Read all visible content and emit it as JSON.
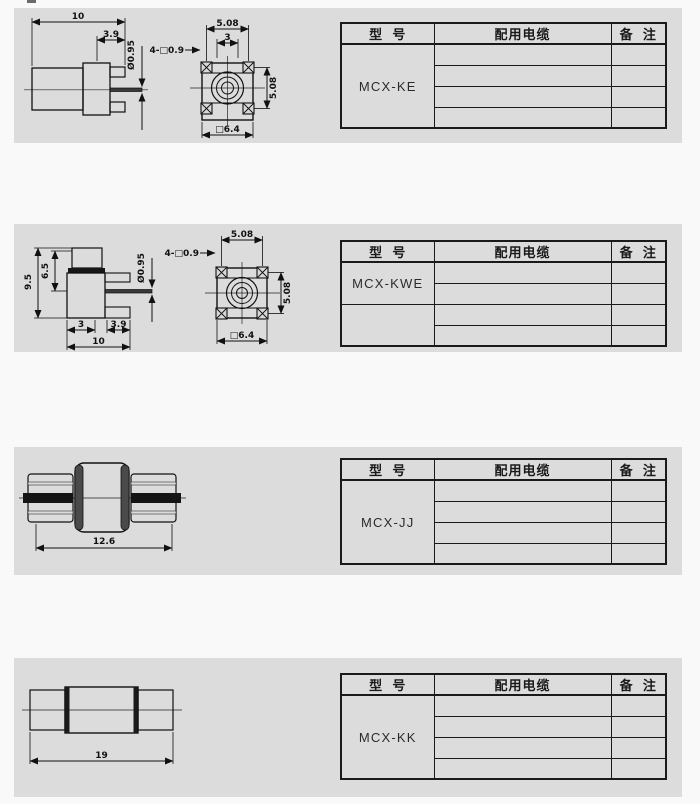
{
  "colors": {
    "panel": "#dcdcdd",
    "page_background": "#f9f9f9",
    "line": "#111111"
  },
  "table_headers": {
    "model": "型  号",
    "cable": "配用电缆",
    "remark": "备  注"
  },
  "sections": [
    {
      "model": "MCX-KE",
      "dims": {
        "overall_width": "10",
        "tail_length": "3.9",
        "pin_diameter": "Ø0.95",
        "pin_pitch_horizontal": "5.08",
        "slot_width": "3",
        "pin_square": "4-□0.9",
        "pin_pitch_vertical": "5.08",
        "body_square": "□6.4"
      }
    },
    {
      "model": "MCX-KWE",
      "dims": {
        "overall_height": "9.5",
        "body_height": "6.5",
        "pin_diameter": "Ø0.95",
        "slot_width": "3",
        "tail_length": "3.9",
        "overall_width": "10",
        "pin_pitch_horizontal": "5.08",
        "pin_square": "4-□0.9",
        "pin_pitch_vertical": "5.08",
        "body_square": "□6.4"
      }
    },
    {
      "model": "MCX-JJ",
      "dims": {
        "overall_length": "12.6"
      }
    },
    {
      "model": "MCX-KK",
      "dims": {
        "overall_length": "19"
      }
    }
  ]
}
